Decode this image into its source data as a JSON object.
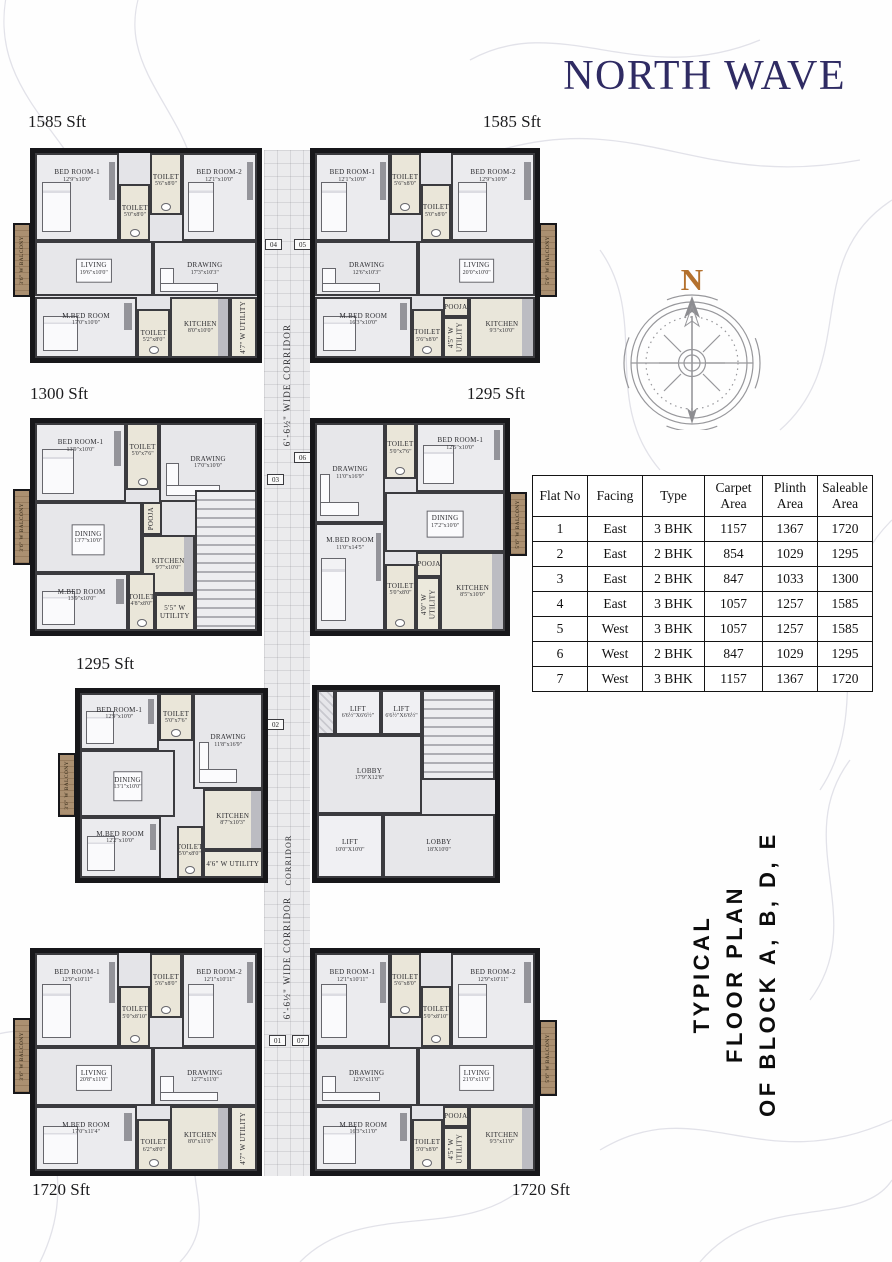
{
  "title": "NORTH WAVE",
  "compass": {
    "label": "N"
  },
  "caption": {
    "line1": "TYPICAL",
    "line2": "FLOOR PLAN",
    "line3": "OF BLOCK A, B, D, E"
  },
  "colors": {
    "title": "#2f2b63",
    "compass_n": "#b4712e",
    "caption": "#0c0c0c",
    "balcony_wood": "#a28565"
  },
  "flat_table": {
    "headers": [
      "Flat No",
      "Facing",
      "Type",
      "Carpet Area",
      "Plinth Area",
      "Saleable Area"
    ],
    "rows": [
      [
        "1",
        "East",
        "3 BHK",
        "1157",
        "1367",
        "1720"
      ],
      [
        "2",
        "East",
        "2 BHK",
        "854",
        "1029",
        "1295"
      ],
      [
        "3",
        "East",
        "2 BHK",
        "847",
        "1033",
        "1300"
      ],
      [
        "4",
        "East",
        "3 BHK",
        "1057",
        "1257",
        "1585"
      ],
      [
        "5",
        "West",
        "3 BHK",
        "1057",
        "1257",
        "1585"
      ],
      [
        "6",
        "West",
        "2 BHK",
        "847",
        "1029",
        "1295"
      ],
      [
        "7",
        "West",
        "3 BHK",
        "1157",
        "1367",
        "1720"
      ]
    ]
  },
  "corridor": {
    "box": {
      "x": 264,
      "y": 150,
      "w": 46,
      "h": 1026
    },
    "labels": [
      {
        "text": "6'-6½\" WIDE CORRIDOR",
        "cx": 287,
        "cy": 385,
        "w": 230,
        "size": 9
      },
      {
        "text": "6'-6½\" WIDE CORRIDOR",
        "cx": 287,
        "cy": 958,
        "w": 230,
        "size": 9
      },
      {
        "text": "CORRIDOR",
        "cx": 288,
        "cy": 860,
        "w": 80,
        "size": 8
      }
    ],
    "tags": [
      {
        "label": "04",
        "x": 265,
        "y": 239
      },
      {
        "label": "05",
        "x": 294,
        "y": 239
      },
      {
        "label": "06",
        "x": 294,
        "y": 452
      },
      {
        "label": "03",
        "x": 267,
        "y": 474
      },
      {
        "label": "02",
        "x": 267,
        "y": 719
      },
      {
        "label": "01",
        "x": 269,
        "y": 1035
      },
      {
        "label": "07",
        "x": 292,
        "y": 1035
      }
    ]
  },
  "core": {
    "name": "central-core",
    "box": {
      "x": 312,
      "y": 685,
      "w": 188,
      "h": 198
    },
    "rooms": [
      {
        "label": "",
        "dim": "",
        "x": 0,
        "y": 0,
        "w": 10,
        "h": 24,
        "type": "shaft"
      },
      {
        "label": "LIFT",
        "dim": "6'6½\"X6'6½\"",
        "x": 10,
        "y": 0,
        "w": 26,
        "h": 24,
        "type": "lift"
      },
      {
        "label": "LIFT",
        "dim": "6'6½\"X6'6½\"",
        "x": 36,
        "y": 0,
        "w": 23,
        "h": 24,
        "type": "lift"
      },
      {
        "label": "",
        "dim": "",
        "x": 59,
        "y": 0,
        "w": 41,
        "h": 48,
        "type": "stairs"
      },
      {
        "label": "LOBBY",
        "dim": "17'9\"X12'8\"",
        "x": 0,
        "y": 24,
        "w": 59,
        "h": 42,
        "type": "lobby"
      },
      {
        "label": "LIFT",
        "dim": "10'0\"X10'0\"",
        "x": 0,
        "y": 66,
        "w": 37,
        "h": 34,
        "type": "lift"
      },
      {
        "label": "LOBBY",
        "dim": "18'X10'0\"",
        "x": 37,
        "y": 66,
        "w": 63,
        "h": 34,
        "type": "lobby"
      }
    ]
  },
  "units": [
    {
      "name": "unit-1-top-left-1585",
      "area_label": "1585 Sft",
      "label": {
        "x": 28,
        "y": 112,
        "align": "left"
      },
      "box": {
        "x": 30,
        "y": 148,
        "w": 232,
        "h": 215
      },
      "balcony": {
        "x": 13,
        "y": 223,
        "w": 18,
        "h": 74,
        "label": "3'6\" W BALCONY",
        "side": "left"
      },
      "rooms": [
        {
          "label": "BED ROOM-1",
          "dim": "12'9\"x10'0\"",
          "x": 0,
          "y": 0,
          "w": 38,
          "h": 43,
          "type": "bedroom"
        },
        {
          "label": "TOILET",
          "dim": "5'0\"x8'0\"",
          "x": 38,
          "y": 15,
          "w": 14,
          "h": 28,
          "type": "toilet"
        },
        {
          "label": "TOILET",
          "dim": "5'6\"x8'0\"",
          "x": 52,
          "y": 0,
          "w": 14,
          "h": 30,
          "type": "toilet"
        },
        {
          "label": "BED ROOM-2",
          "dim": "12'1\"x10'0\"",
          "x": 66,
          "y": 0,
          "w": 34,
          "h": 43,
          "type": "bedroom"
        },
        {
          "label": "LIVING",
          "dim": "19'6\"x10'0\"",
          "x": 0,
          "y": 43,
          "w": 53,
          "h": 27,
          "type": "living"
        },
        {
          "label": "DRAWING",
          "dim": "17'3\"x10'3\"",
          "x": 53,
          "y": 43,
          "w": 47,
          "h": 27,
          "type": "drawing"
        },
        {
          "label": "M.BED ROOM",
          "dim": "17'0\"x10'0\"",
          "x": 0,
          "y": 70,
          "w": 46,
          "h": 30,
          "type": "bedroom"
        },
        {
          "label": "TOILET",
          "dim": "5'2\"x8'0\"",
          "x": 46,
          "y": 76,
          "w": 15,
          "h": 24,
          "type": "toilet"
        },
        {
          "label": "KITCHEN",
          "dim": "8'0\"x10'0\"",
          "x": 61,
          "y": 70,
          "w": 27,
          "h": 30,
          "type": "kitchen"
        },
        {
          "label": "4'7\" W UTILITY",
          "dim": "",
          "x": 88,
          "y": 70,
          "w": 12,
          "h": 30,
          "type": "utility",
          "vert": true
        }
      ]
    },
    {
      "name": "unit-2-top-right-1585",
      "area_label": "1585 Sft",
      "label": {
        "x": 541,
        "y": 112,
        "align": "right"
      },
      "box": {
        "x": 310,
        "y": 148,
        "w": 230,
        "h": 215
      },
      "balcony": {
        "x": 539,
        "y": 223,
        "w": 18,
        "h": 74,
        "label": "5'6\" W BALCONY",
        "side": "right"
      },
      "rooms": [
        {
          "label": "BED ROOM-1",
          "dim": "12'1\"x10'0\"",
          "x": 0,
          "y": 0,
          "w": 34,
          "h": 43,
          "type": "bedroom"
        },
        {
          "label": "TOILET",
          "dim": "5'6\"x8'0\"",
          "x": 34,
          "y": 0,
          "w": 14,
          "h": 30,
          "type": "toilet"
        },
        {
          "label": "TOILET",
          "dim": "5'0\"x8'0\"",
          "x": 48,
          "y": 15,
          "w": 14,
          "h": 28,
          "type": "toilet"
        },
        {
          "label": "BED ROOM-2",
          "dim": "12'9\"x10'0\"",
          "x": 62,
          "y": 0,
          "w": 38,
          "h": 43,
          "type": "bedroom"
        },
        {
          "label": "DRAWING",
          "dim": "12'6\"x10'3\"",
          "x": 0,
          "y": 43,
          "w": 47,
          "h": 27,
          "type": "drawing"
        },
        {
          "label": "LIVING",
          "dim": "20'0\"x10'0\"",
          "x": 47,
          "y": 43,
          "w": 53,
          "h": 27,
          "type": "living"
        },
        {
          "label": "M.BED ROOM",
          "dim": "16'3\"x10'0\"",
          "x": 0,
          "y": 70,
          "w": 44,
          "h": 30,
          "type": "bedroom"
        },
        {
          "label": "TOILET",
          "dim": "5'6\"x8'0\"",
          "x": 44,
          "y": 76,
          "w": 14,
          "h": 24,
          "type": "toilet"
        },
        {
          "label": "POOJA",
          "dim": "",
          "x": 58,
          "y": 70,
          "w": 12,
          "h": 10,
          "type": "pooja"
        },
        {
          "label": "4'5\" W UTILITY",
          "dim": "",
          "x": 58,
          "y": 80,
          "w": 12,
          "h": 20,
          "type": "utility",
          "vert": true
        },
        {
          "label": "KITCHEN",
          "dim": "9'3\"x10'0\"",
          "x": 70,
          "y": 70,
          "w": 30,
          "h": 30,
          "type": "kitchen"
        }
      ]
    },
    {
      "name": "unit-3-mid-left-1300",
      "area_label": "1300 Sft",
      "label": {
        "x": 30,
        "y": 384,
        "align": "left"
      },
      "box": {
        "x": 30,
        "y": 418,
        "w": 232,
        "h": 218
      },
      "balcony": {
        "x": 13,
        "y": 489,
        "w": 18,
        "h": 76,
        "label": "3'6\" W BALCONY",
        "side": "left"
      },
      "rooms": [
        {
          "label": "BED ROOM-1",
          "dim": "13'9\"x10'0\"",
          "x": 0,
          "y": 0,
          "w": 41,
          "h": 38,
          "type": "bedroom"
        },
        {
          "label": "TOILET",
          "dim": "5'0\"x7'6\"",
          "x": 41,
          "y": 0,
          "w": 15,
          "h": 32,
          "type": "toilet"
        },
        {
          "label": "DRAWING",
          "dim": "17'0\"x10'0\"",
          "x": 56,
          "y": 0,
          "w": 44,
          "h": 38,
          "type": "drawing"
        },
        {
          "label": "DINING",
          "dim": "13'7\"x10'0\"",
          "x": 0,
          "y": 38,
          "w": 48,
          "h": 34,
          "type": "living"
        },
        {
          "label": "POOJA",
          "dim": "",
          "x": 48,
          "y": 38,
          "w": 9,
          "h": 16,
          "type": "pooja",
          "vert": true
        },
        {
          "label": "KITCHEN",
          "dim": "9'7\"x10'0\"",
          "x": 48,
          "y": 54,
          "w": 24,
          "h": 28,
          "type": "kitchen"
        },
        {
          "label": "",
          "dim": "",
          "x": 72,
          "y": 32,
          "w": 28,
          "h": 68,
          "type": "stairs"
        },
        {
          "label": "M.BED ROOM",
          "dim": "13'9\"x10'0\"",
          "x": 0,
          "y": 72,
          "w": 42,
          "h": 28,
          "type": "bedroom"
        },
        {
          "label": "TOILET",
          "dim": "4'8\"x8'0\"",
          "x": 42,
          "y": 72,
          "w": 12,
          "h": 28,
          "type": "toilet"
        },
        {
          "label": "5'5\" W UTILITY",
          "dim": "",
          "x": 54,
          "y": 82,
          "w": 18,
          "h": 18,
          "type": "utility"
        }
      ]
    },
    {
      "name": "unit-4-mid-right-1295",
      "area_label": "1295 Sft",
      "label": {
        "x": 525,
        "y": 384,
        "align": "right"
      },
      "box": {
        "x": 310,
        "y": 418,
        "w": 200,
        "h": 218
      },
      "balcony": {
        "x": 509,
        "y": 492,
        "w": 18,
        "h": 64,
        "label": "5'6\" W BALCONY",
        "side": "right"
      },
      "rooms": [
        {
          "label": "DRAWING",
          "dim": "11'0\"x16'9\"",
          "x": 0,
          "y": 0,
          "w": 37,
          "h": 48,
          "type": "drawing"
        },
        {
          "label": "TOILET",
          "dim": "5'0\"x7'6\"",
          "x": 37,
          "y": 0,
          "w": 16,
          "h": 27,
          "type": "toilet"
        },
        {
          "label": "BED ROOM-1",
          "dim": "12'5\"x10'0\"",
          "x": 53,
          "y": 0,
          "w": 47,
          "h": 33,
          "type": "bedroom"
        },
        {
          "label": "DINING",
          "dim": "17'2\"x10'0\"",
          "x": 37,
          "y": 33,
          "w": 63,
          "h": 29,
          "type": "living"
        },
        {
          "label": "M.BED ROOM",
          "dim": "11'0\"x14'5\"",
          "x": 0,
          "y": 48,
          "w": 37,
          "h": 52,
          "type": "bedroom"
        },
        {
          "label": "TOILET",
          "dim": "5'0\"x8'0\"",
          "x": 37,
          "y": 68,
          "w": 16,
          "h": 32,
          "type": "toilet"
        },
        {
          "label": "POOJA",
          "dim": "",
          "x": 53,
          "y": 62,
          "w": 14,
          "h": 12,
          "type": "pooja"
        },
        {
          "label": "4'0\" W UTILITY",
          "dim": "",
          "x": 53,
          "y": 74,
          "w": 13,
          "h": 26,
          "type": "utility",
          "vert": true
        },
        {
          "label": "KITCHEN",
          "dim": "8'5\"x10'0\"",
          "x": 66,
          "y": 62,
          "w": 34,
          "h": 38,
          "type": "kitchen"
        }
      ]
    },
    {
      "name": "unit-5-lower-left-1295",
      "area_label": "1295 Sft",
      "label": {
        "x": 76,
        "y": 654,
        "align": "left"
      },
      "box": {
        "x": 75,
        "y": 688,
        "w": 193,
        "h": 195
      },
      "balcony": {
        "x": 58,
        "y": 753,
        "w": 18,
        "h": 64,
        "label": "3'6\" W BALCONY",
        "side": "left"
      },
      "rooms": [
        {
          "label": "BED ROOM-1",
          "dim": "12'9\"x10'0\"",
          "x": 0,
          "y": 0,
          "w": 43,
          "h": 31,
          "type": "bedroom"
        },
        {
          "label": "TOILET",
          "dim": "5'0\"x7'6\"",
          "x": 43,
          "y": 0,
          "w": 19,
          "h": 26,
          "type": "toilet"
        },
        {
          "label": "DRAWING",
          "dim": "11'8\"x16'9\"",
          "x": 62,
          "y": 0,
          "w": 38,
          "h": 52,
          "type": "drawing"
        },
        {
          "label": "DINING",
          "dim": "13'1\"x10'0\"",
          "x": 0,
          "y": 31,
          "w": 52,
          "h": 36,
          "type": "living"
        },
        {
          "label": "M.BED ROOM",
          "dim": "12'2\"x10'0\"",
          "x": 0,
          "y": 67,
          "w": 44,
          "h": 33,
          "type": "bedroom"
        },
        {
          "label": "TOILET",
          "dim": "5'0\"x8'0\"",
          "x": 53,
          "y": 72,
          "w": 14,
          "h": 28,
          "type": "toilet"
        },
        {
          "label": "KITCHEN",
          "dim": "8'7\"x10'3\"",
          "x": 67,
          "y": 52,
          "w": 33,
          "h": 33,
          "type": "kitchen"
        },
        {
          "label": "4'6\" W UTILITY",
          "dim": "",
          "x": 67,
          "y": 85,
          "w": 33,
          "h": 15,
          "type": "utility"
        }
      ]
    },
    {
      "name": "unit-6-bottom-left-1720",
      "area_label": "1720 Sft",
      "label": {
        "x": 32,
        "y": 1180,
        "align": "left"
      },
      "box": {
        "x": 30,
        "y": 948,
        "w": 232,
        "h": 228
      },
      "balcony": {
        "x": 13,
        "y": 1018,
        "w": 18,
        "h": 76,
        "label": "3'6\" W BALCONY",
        "side": "left"
      },
      "rooms": [
        {
          "label": "BED ROOM-1",
          "dim": "12'9\"x10'11\"",
          "x": 0,
          "y": 0,
          "w": 38,
          "h": 43,
          "type": "bedroom"
        },
        {
          "label": "TOILET",
          "dim": "5'0\"x8'10\"",
          "x": 38,
          "y": 15,
          "w": 14,
          "h": 28,
          "type": "toilet"
        },
        {
          "label": "TOILET",
          "dim": "5'6\"x8'0\"",
          "x": 52,
          "y": 0,
          "w": 14,
          "h": 30,
          "type": "toilet"
        },
        {
          "label": "BED ROOM-2",
          "dim": "12'1\"x10'11\"",
          "x": 66,
          "y": 0,
          "w": 34,
          "h": 43,
          "type": "bedroom"
        },
        {
          "label": "LIVING",
          "dim": "20'8\"x11'0\"",
          "x": 0,
          "y": 43,
          "w": 53,
          "h": 27,
          "type": "living"
        },
        {
          "label": "DRAWING",
          "dim": "12'7\"x11'0\"",
          "x": 53,
          "y": 43,
          "w": 47,
          "h": 27,
          "type": "drawing"
        },
        {
          "label": "M.BED ROOM",
          "dim": "17'0\"x11'4\"",
          "x": 0,
          "y": 70,
          "w": 46,
          "h": 30,
          "type": "bedroom"
        },
        {
          "label": "TOILET",
          "dim": "6'2\"x8'0\"",
          "x": 46,
          "y": 76,
          "w": 15,
          "h": 24,
          "type": "toilet"
        },
        {
          "label": "KITCHEN",
          "dim": "8'0\"x11'0\"",
          "x": 61,
          "y": 70,
          "w": 27,
          "h": 30,
          "type": "kitchen"
        },
        {
          "label": "4'7\" W UTILITY",
          "dim": "",
          "x": 88,
          "y": 70,
          "w": 12,
          "h": 30,
          "type": "utility",
          "vert": true
        }
      ]
    },
    {
      "name": "unit-7-bottom-right-1720",
      "area_label": "1720 Sft",
      "label": {
        "x": 570,
        "y": 1180,
        "align": "right"
      },
      "box": {
        "x": 310,
        "y": 948,
        "w": 230,
        "h": 228
      },
      "balcony": {
        "x": 539,
        "y": 1020,
        "w": 18,
        "h": 76,
        "label": "5'6\" W BALCONY",
        "side": "right"
      },
      "rooms": [
        {
          "label": "BED ROOM-1",
          "dim": "12'1\"x10'11\"",
          "x": 0,
          "y": 0,
          "w": 34,
          "h": 43,
          "type": "bedroom"
        },
        {
          "label": "TOILET",
          "dim": "5'6\"x8'0\"",
          "x": 34,
          "y": 0,
          "w": 14,
          "h": 30,
          "type": "toilet"
        },
        {
          "label": "TOILET",
          "dim": "5'0\"x8'10\"",
          "x": 48,
          "y": 15,
          "w": 14,
          "h": 28,
          "type": "toilet"
        },
        {
          "label": "BED ROOM-2",
          "dim": "12'9\"x10'11\"",
          "x": 62,
          "y": 0,
          "w": 38,
          "h": 43,
          "type": "bedroom"
        },
        {
          "label": "DRAWING",
          "dim": "12'6\"x11'0\"",
          "x": 0,
          "y": 43,
          "w": 47,
          "h": 27,
          "type": "drawing"
        },
        {
          "label": "LIVING",
          "dim": "21'0\"x11'0\"",
          "x": 47,
          "y": 43,
          "w": 53,
          "h": 27,
          "type": "living"
        },
        {
          "label": "M.BED ROOM",
          "dim": "16'3\"x11'0\"",
          "x": 0,
          "y": 70,
          "w": 44,
          "h": 30,
          "type": "bedroom"
        },
        {
          "label": "TOILET",
          "dim": "5'0\"x8'0\"",
          "x": 44,
          "y": 76,
          "w": 14,
          "h": 24,
          "type": "toilet"
        },
        {
          "label": "POOJA",
          "dim": "",
          "x": 58,
          "y": 70,
          "w": 12,
          "h": 10,
          "type": "pooja"
        },
        {
          "label": "4'5\" W UTILITY",
          "dim": "",
          "x": 58,
          "y": 80,
          "w": 12,
          "h": 20,
          "type": "utility",
          "vert": true
        },
        {
          "label": "KITCHEN",
          "dim": "9'3\"x11'0\"",
          "x": 70,
          "y": 70,
          "w": 30,
          "h": 30,
          "type": "kitchen"
        }
      ]
    }
  ]
}
